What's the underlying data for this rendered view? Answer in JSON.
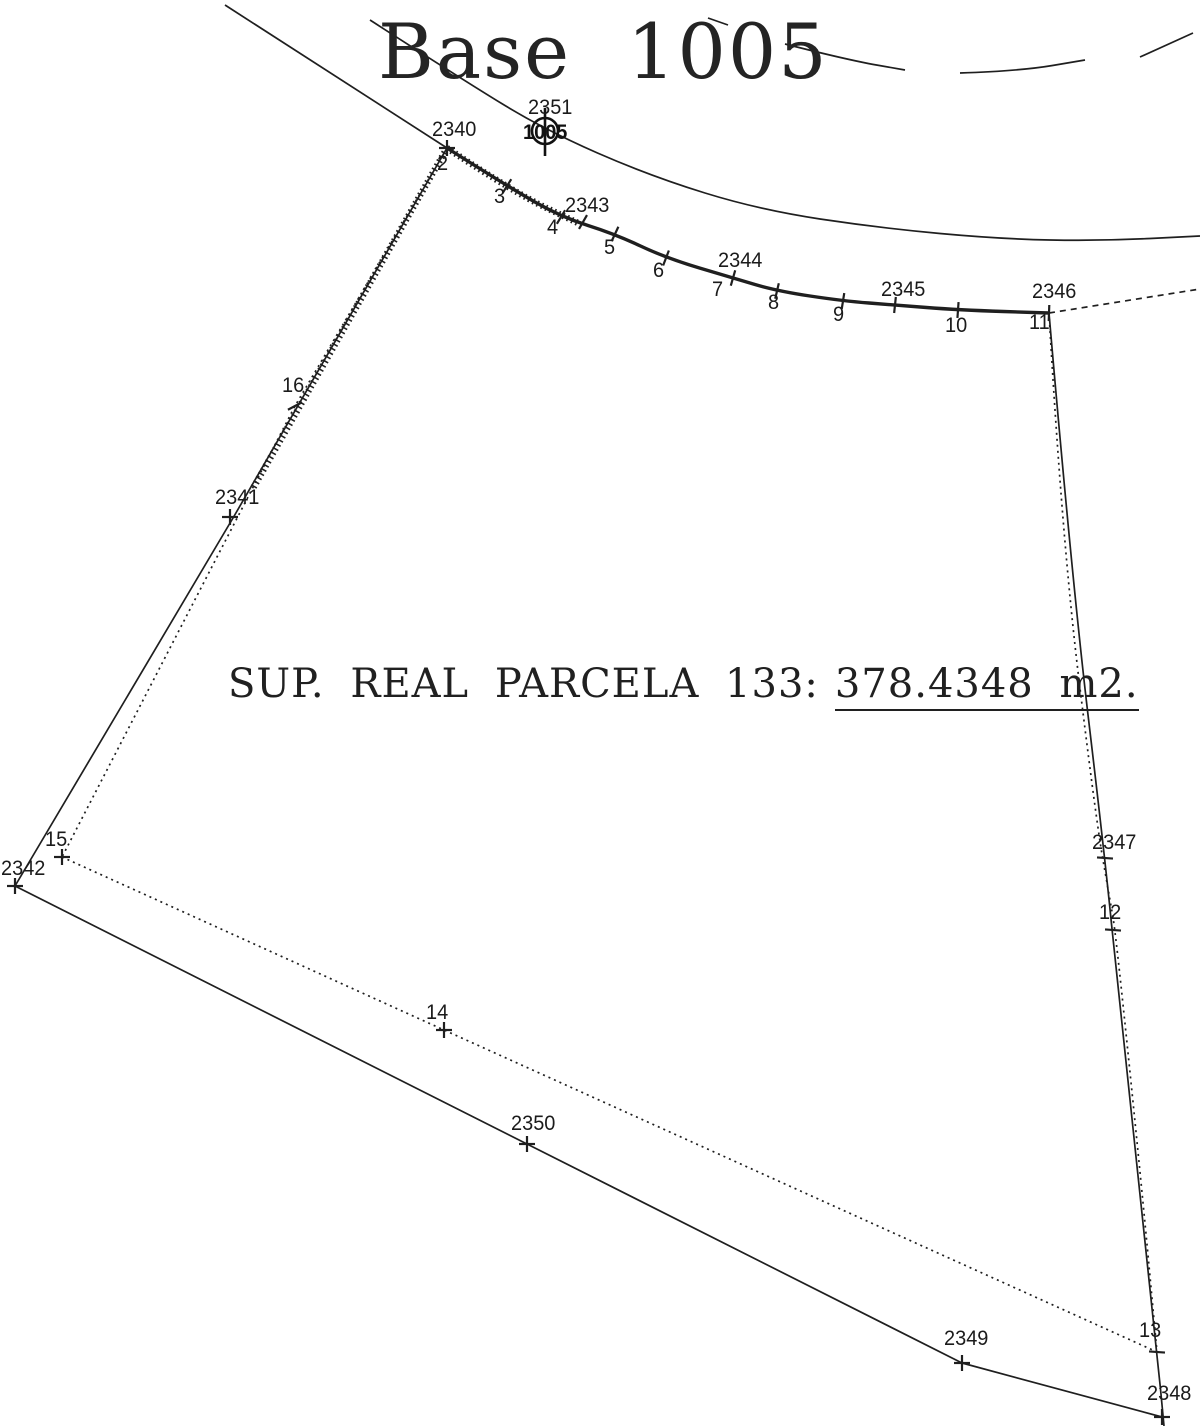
{
  "title": {
    "word1": "Base",
    "word2": "1005"
  },
  "area_label": {
    "prefix": "SUP. REAL PARCELA 133:",
    "value": "378.4348 m2."
  },
  "colors": {
    "ink": "#1f1f1f",
    "background": "#ffffff"
  },
  "base_station": {
    "id": "2351",
    "symbol_text": "1005",
    "x": 545,
    "y": 131,
    "r": 13,
    "label_x": 528,
    "label_y": 97
  },
  "points": [
    {
      "id": "2340",
      "x": 447,
      "y": 148,
      "kind": "cross",
      "rot": 0,
      "lx": 432,
      "ly": 119
    },
    {
      "id": "2",
      "x": 447,
      "y": 148,
      "kind": "none",
      "rot": 0,
      "lx": 437,
      "ly": 153
    },
    {
      "id": "3",
      "x": 507,
      "y": 186,
      "kind": "tick",
      "rot": 32,
      "lx": 494,
      "ly": 186
    },
    {
      "id": "4",
      "x": 561,
      "y": 217,
      "kind": "tick",
      "rot": 31,
      "lx": 547,
      "ly": 217
    },
    {
      "id": "2343",
      "x": 583,
      "y": 222,
      "kind": "tick",
      "rot": 30,
      "lx": 565,
      "ly": 195
    },
    {
      "id": "5",
      "x": 615,
      "y": 234,
      "kind": "tick",
      "rot": 25,
      "lx": 604,
      "ly": 237
    },
    {
      "id": "6",
      "x": 666,
      "y": 258,
      "kind": "tick",
      "rot": 21,
      "lx": 653,
      "ly": 260
    },
    {
      "id": "2344",
      "x": 733,
      "y": 278,
      "kind": "tick",
      "rot": 16,
      "lx": 718,
      "ly": 250
    },
    {
      "id": "7",
      "x": 733,
      "y": 278,
      "kind": "none",
      "rot": 0,
      "lx": 712,
      "ly": 279
    },
    {
      "id": "8",
      "x": 777,
      "y": 291,
      "kind": "tick",
      "rot": 13,
      "lx": 768,
      "ly": 292
    },
    {
      "id": "9",
      "x": 843,
      "y": 301,
      "kind": "tick",
      "rot": 9,
      "lx": 833,
      "ly": 304
    },
    {
      "id": "2345",
      "x": 895,
      "y": 305,
      "kind": "tick",
      "rot": 6,
      "lx": 881,
      "ly": 279
    },
    {
      "id": "10",
      "x": 958,
      "y": 310,
      "kind": "tick",
      "rot": 4,
      "lx": 945,
      "ly": 315
    },
    {
      "id": "2346",
      "x": 1049,
      "y": 313,
      "kind": "tick",
      "rot": 2,
      "lx": 1032,
      "ly": 281
    },
    {
      "id": "11",
      "x": 1049,
      "y": 313,
      "kind": "none",
      "rot": 0,
      "lx": 1029,
      "ly": 312
    },
    {
      "id": "16",
      "x": 295,
      "y": 406,
      "kind": "tick",
      "rot": 62,
      "lx": 282,
      "ly": 375
    },
    {
      "id": "2341",
      "x": 230,
      "y": 517,
      "kind": "cross",
      "rot": 0,
      "lx": 215,
      "ly": 487
    },
    {
      "id": "15",
      "x": 62,
      "y": 857,
      "kind": "cross",
      "rot": 0,
      "lx": 45,
      "ly": 829
    },
    {
      "id": "2342",
      "x": 15,
      "y": 886,
      "kind": "cross",
      "rot": 0,
      "lx": 1,
      "ly": 858
    },
    {
      "id": "2347",
      "x": 1105,
      "y": 858,
      "kind": "tick",
      "rot": 94,
      "lx": 1092,
      "ly": 832
    },
    {
      "id": "12",
      "x": 1113,
      "y": 930,
      "kind": "tick",
      "rot": 94,
      "lx": 1099,
      "ly": 902
    },
    {
      "id": "14",
      "x": 444,
      "y": 1030,
      "kind": "cross",
      "rot": 0,
      "lx": 426,
      "ly": 1002
    },
    {
      "id": "2350",
      "x": 527,
      "y": 1144,
      "kind": "cross",
      "rot": 0,
      "lx": 511,
      "ly": 1113
    },
    {
      "id": "2349",
      "x": 962,
      "y": 1363,
      "kind": "cross",
      "rot": 0,
      "lx": 944,
      "ly": 1328
    },
    {
      "id": "13",
      "x": 1157,
      "y": 1352,
      "kind": "tick",
      "rot": 94,
      "lx": 1139,
      "ly": 1320
    },
    {
      "id": "2348",
      "x": 1162,
      "y": 1417,
      "kind": "cross",
      "rot": 0,
      "lx": 1147,
      "ly": 1383
    }
  ],
  "lines": [
    {
      "name": "approach-line",
      "style": "thin",
      "smooth": false,
      "pts": [
        [
          225,
          5
        ],
        [
          447,
          148
        ]
      ]
    },
    {
      "name": "road-centerline",
      "style": "thin",
      "smooth": true,
      "pts": [
        [
          370,
          20
        ],
        [
          460,
          78
        ],
        [
          545,
          130
        ],
        [
          650,
          176
        ],
        [
          760,
          210
        ],
        [
          880,
          228
        ],
        [
          1000,
          239
        ],
        [
          1100,
          241
        ],
        [
          1200,
          236
        ]
      ]
    },
    {
      "name": "outer-curb-dash-1",
      "style": "thin",
      "smooth": false,
      "pts": [
        [
          708,
          18
        ],
        [
          728,
          25
        ]
      ]
    },
    {
      "name": "outer-curb-dash-2",
      "style": "thin",
      "smooth": true,
      "pts": [
        [
          785,
          44
        ],
        [
          848,
          60
        ],
        [
          905,
          70
        ]
      ]
    },
    {
      "name": "outer-curb-dash-3",
      "style": "thin",
      "smooth": true,
      "pts": [
        [
          960,
          73
        ],
        [
          1020,
          71
        ],
        [
          1085,
          60
        ]
      ]
    },
    {
      "name": "outer-curb-dash-4",
      "style": "thin",
      "smooth": false,
      "pts": [
        [
          1140,
          57
        ],
        [
          1193,
          33
        ]
      ]
    },
    {
      "name": "front-boundary-curve",
      "style": "thick",
      "smooth": true,
      "pts": [
        [
          447,
          148
        ],
        [
          507,
          186
        ],
        [
          561,
          217
        ],
        [
          615,
          234
        ],
        [
          666,
          258
        ],
        [
          733,
          278
        ],
        [
          777,
          291
        ],
        [
          843,
          301
        ],
        [
          895,
          305
        ],
        [
          958,
          310
        ],
        [
          1049,
          313
        ]
      ]
    },
    {
      "name": "front-curve-hatch",
      "style": "hatch",
      "smooth": true,
      "pts": [
        [
          447,
          148
        ],
        [
          515,
          193
        ],
        [
          578,
          223
        ]
      ]
    },
    {
      "name": "road-continuation",
      "style": "dashed",
      "smooth": false,
      "pts": [
        [
          1049,
          313
        ],
        [
          1200,
          289
        ]
      ]
    },
    {
      "name": "left-traverse",
      "style": "thin",
      "smooth": false,
      "pts": [
        [
          447,
          148
        ],
        [
          233,
          518
        ],
        [
          15,
          886
        ]
      ]
    },
    {
      "name": "left-boundary",
      "style": "dotted",
      "smooth": false,
      "pts": [
        [
          447,
          148
        ],
        [
          295,
          406
        ],
        [
          62,
          857
        ]
      ]
    },
    {
      "name": "left-boundary-hatch",
      "style": "hatch",
      "smooth": false,
      "pts": [
        [
          447,
          148
        ],
        [
          252,
          490
        ]
      ]
    },
    {
      "name": "rear-boundary",
      "style": "dotted",
      "smooth": false,
      "pts": [
        [
          62,
          857
        ],
        [
          444,
          1030
        ],
        [
          1157,
          1352
        ]
      ]
    },
    {
      "name": "bottom-traverse",
      "style": "thin",
      "smooth": false,
      "pts": [
        [
          15,
          886
        ],
        [
          527,
          1144
        ],
        [
          962,
          1363
        ],
        [
          1162,
          1417
        ]
      ]
    },
    {
      "name": "right-traverse",
      "style": "thin",
      "smooth": true,
      "pts": [
        [
          1049,
          313
        ],
        [
          1072,
          580
        ],
        [
          1105,
          858
        ],
        [
          1118,
          990
        ],
        [
          1157,
          1352
        ],
        [
          1164,
          1426
        ]
      ]
    },
    {
      "name": "right-boundary",
      "style": "dotted",
      "smooth": true,
      "pts": [
        [
          1049,
          313
        ],
        [
          1062,
          540
        ],
        [
          1096,
          820
        ],
        [
          1110,
          900
        ],
        [
          1116,
          935
        ],
        [
          1142,
          1190
        ],
        [
          1157,
          1352
        ]
      ]
    }
  ]
}
